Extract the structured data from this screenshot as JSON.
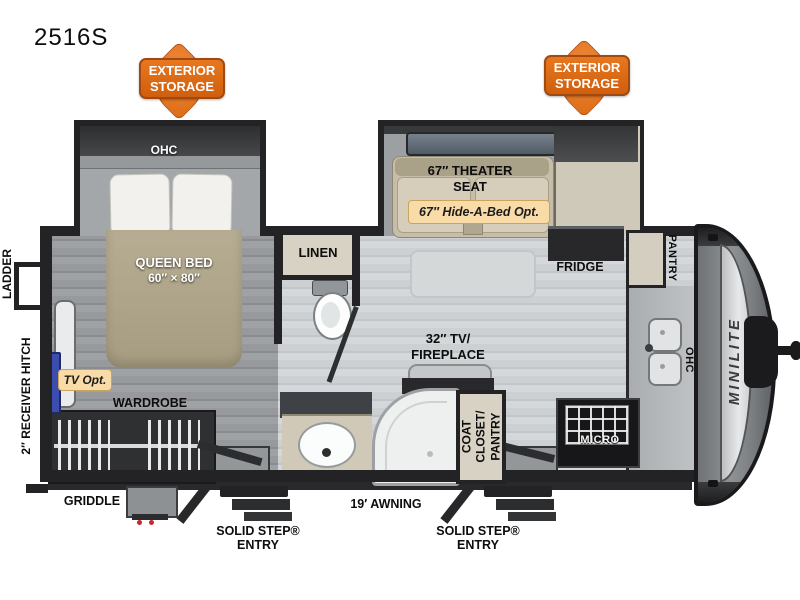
{
  "title": "2516S",
  "callouts": {
    "exterior_storage": {
      "line1": "EXTERIOR",
      "line2": "STORAGE"
    },
    "hide_a_bed": "67″ Hide-A-Bed Opt.",
    "tv_opt": "TV Opt."
  },
  "bedroom": {
    "ohc": "OHC",
    "bed_line1": "QUEEN BED",
    "bed_line2": "60″ × 80″",
    "wardrobe": "WARDROBE"
  },
  "living": {
    "theater_line1": "67″ THEATER",
    "theater_line2": "SEAT",
    "fridge": "FRIDGE",
    "tv_line1": "32″ TV/",
    "tv_line2": "FIREPLACE"
  },
  "bath": {
    "linen": "LINEN"
  },
  "kitchen": {
    "pantry": "PANTRY",
    "ohc": "OHC",
    "micro": "MICRO",
    "coat_line1": "COAT",
    "coat_line2": "CLOSET/",
    "coat_line3": "PANTRY"
  },
  "exterior": {
    "ladder": "LADDER",
    "receiver_hitch": "2″ RECEIVER HITCH",
    "griddle": "GRIDDLE",
    "awning": "19′ AWNING",
    "step_line1": "SOLID STEP®",
    "step_line2": "ENTRY",
    "brand": "MINILITE"
  },
  "colors": {
    "callout_orange": "#e8771f",
    "option_badge_yellow": "#f8dba6",
    "wall_dark": "#232325",
    "floor_main_gray": "#c9ccce",
    "floor_bedroom_gray": "#93969a",
    "bed_tan": "#b2a88d",
    "seat_beige": "#cdc4ae",
    "cabinet_beige": "#d8d2c4",
    "counter_gray": "#b9bcbe",
    "front_cap_gray": "#85888b",
    "window_slate_blue": "#5d6873",
    "tv_blue": "#3c4db0"
  }
}
